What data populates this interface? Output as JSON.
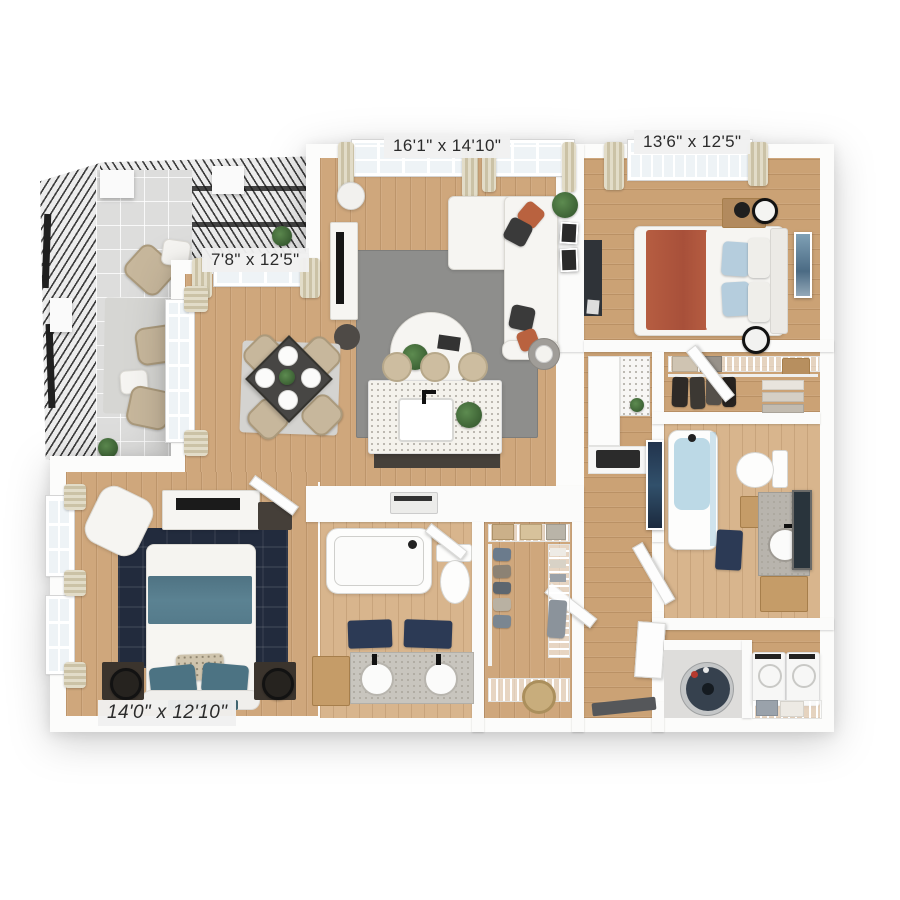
{
  "scene": {
    "description": "3D rendered two-bedroom apartment floor plan, top-down view",
    "background": "#ffffff"
  },
  "dimension_labels": {
    "living_room": "16'1\" x 14'10\"",
    "bedroom_2": "13'6\" x 12'5\"",
    "patio_dining": "7'8\" x 12'5\"",
    "bedroom_1": "14'0\" x 12'10\""
  },
  "palette": {
    "wood_floor": "#cfa77c",
    "wall_white": "#fbfbfa",
    "accent_terracotta": "#b65d41",
    "accent_teal": "#5b8292",
    "rug_gray": "#8e8e8c",
    "rug_navy": "#222b3d",
    "counter_gray": "#c8c5be",
    "curtain_cream": "#d9d2b9",
    "water_heater_navy": "#36414e",
    "glass_blue": "#bcd9e6"
  }
}
